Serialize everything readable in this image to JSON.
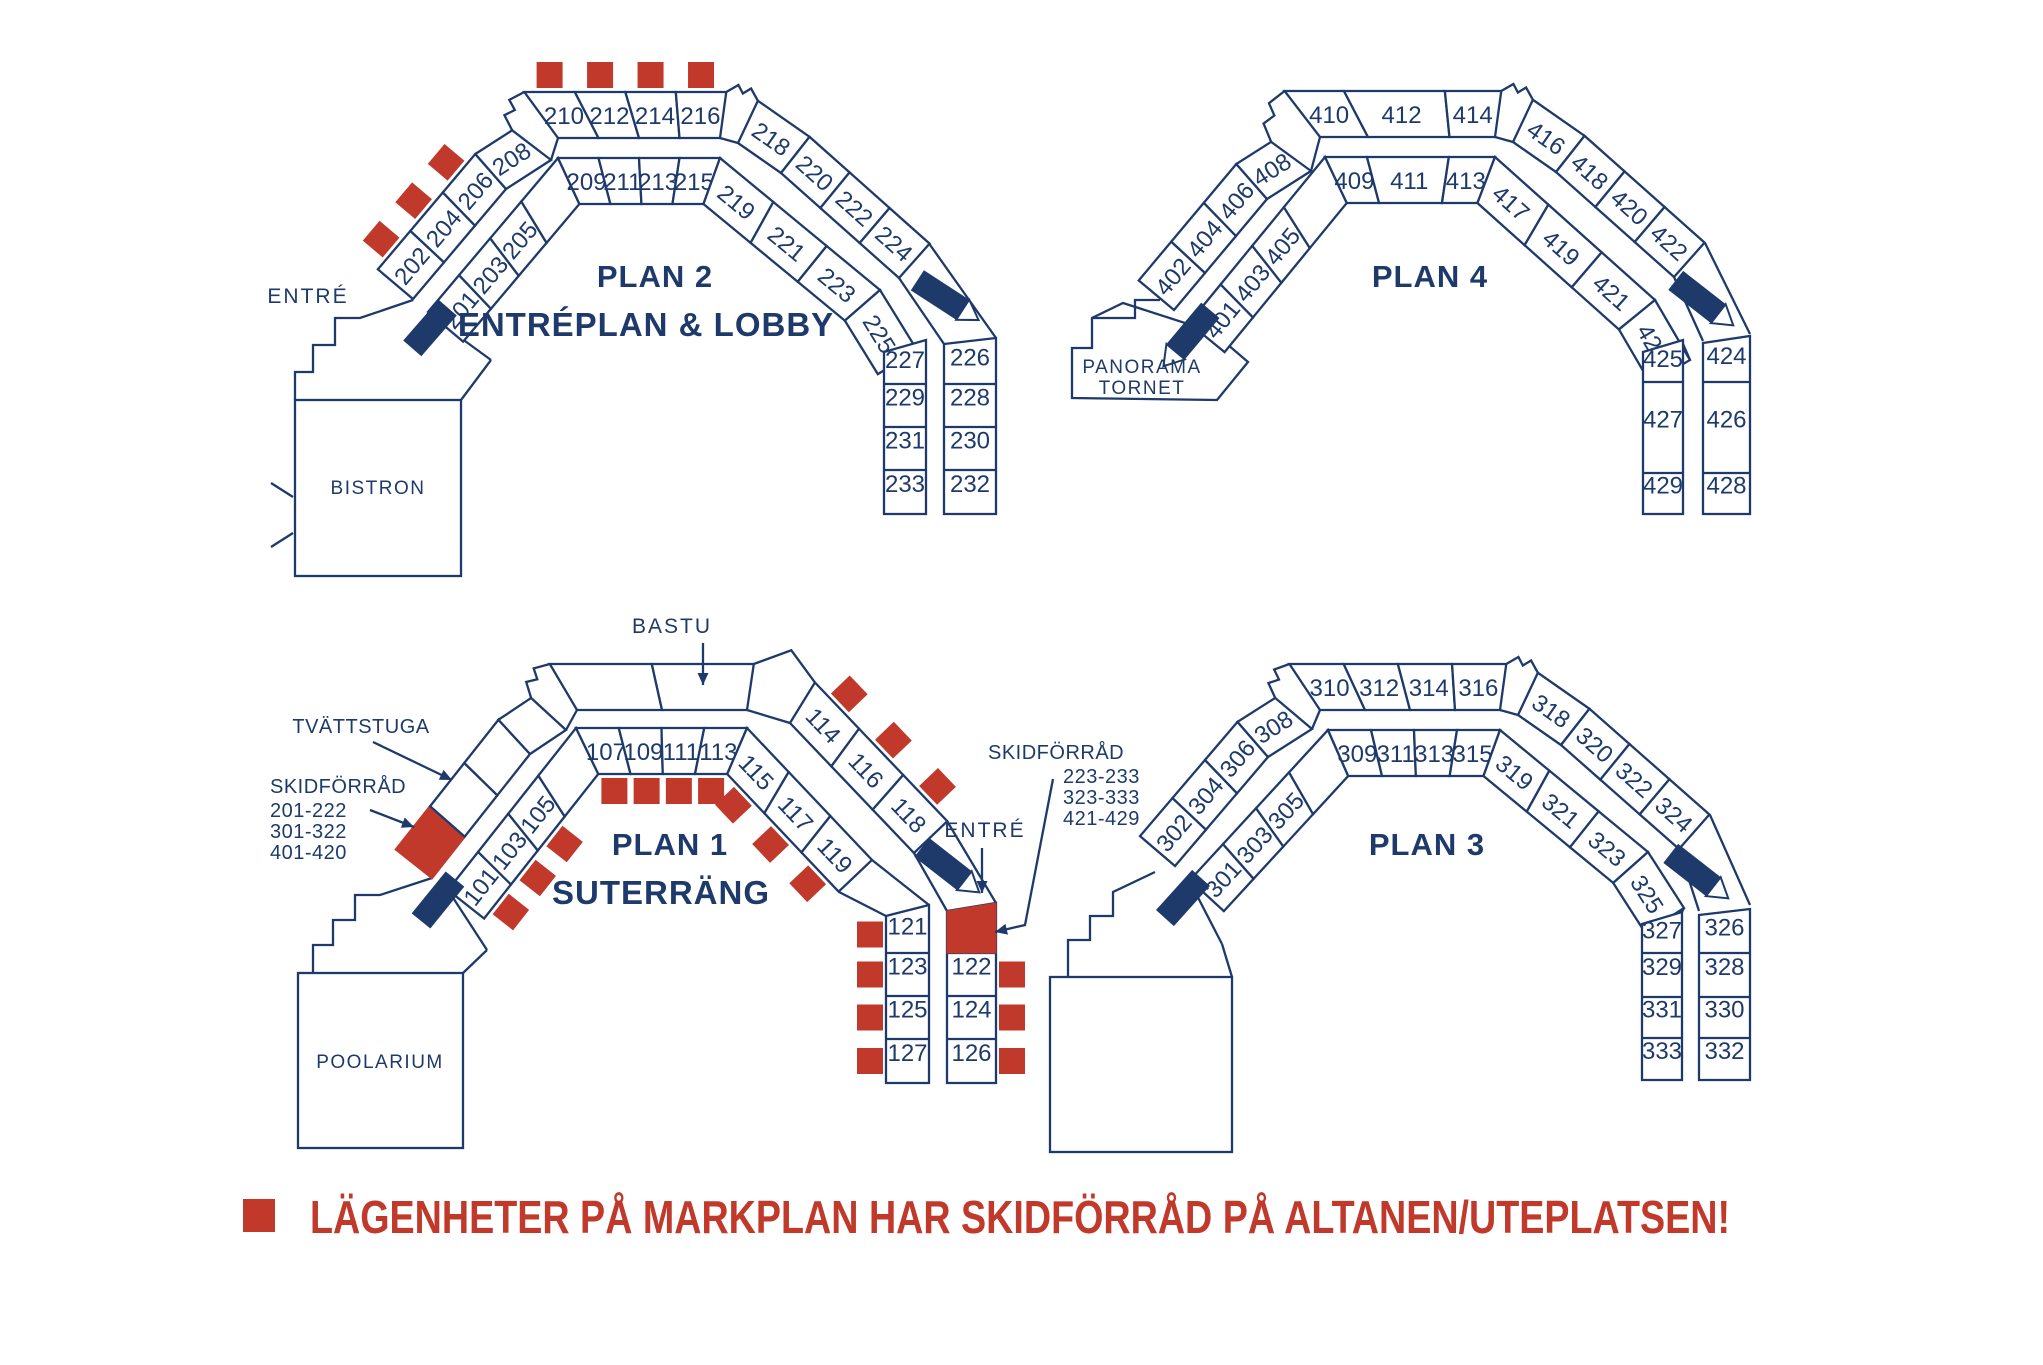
{
  "colors": {
    "navy": "#1e3a6b",
    "red": "#c0392b",
    "white": "#ffffff"
  },
  "labels": {
    "hiss": "Hiss",
    "entre": "ENTRÉ",
    "bastu": "BASTU",
    "tvattstuga": "TVÄTTSTUGA",
    "bistron": "BISTRON",
    "poolarium": "POOLARIUM",
    "panorama": [
      "PANORAMA",
      "TORNET"
    ],
    "skidforrad_title": "SKIDFÖRRÅD",
    "skidforrad_left_ranges": [
      "201-222",
      "301-322",
      "401-420"
    ],
    "skidforrad_right_ranges": [
      "223-233",
      "323-333",
      "421-429"
    ]
  },
  "legend": {
    "text": "LÄGENHETER PÅ MARKPLAN HAR SKIDFÖRRÅD PÅ ALTANEN/UTEPLATSEN!"
  },
  "plans": [
    {
      "id": "plan-2",
      "title": "PLAN 2",
      "subtitle": "ENTRÉPLAN & LOBBY",
      "inner_rooms": [
        "201",
        "203",
        "205",
        "209",
        "211",
        "213",
        "215",
        "219",
        "221",
        "223",
        "225"
      ],
      "outer_rooms": [
        "202",
        "204",
        "206",
        "208",
        "210",
        "212",
        "214",
        "216",
        "218",
        "220",
        "222",
        "224"
      ],
      "column_rooms_left": [
        "227",
        "229",
        "231",
        "233"
      ],
      "column_rooms_right": [
        "226",
        "228",
        "230",
        "232"
      ],
      "ski_storage_marked": [
        "202",
        "204",
        "206",
        "210",
        "212",
        "214",
        "216"
      ]
    },
    {
      "id": "plan-4",
      "title": "PLAN 4",
      "subtitle": "",
      "inner_rooms": [
        "401",
        "403",
        "405",
        "409",
        "411",
        "413",
        "417",
        "419",
        "421",
        "423"
      ],
      "outer_rooms": [
        "402",
        "404",
        "406",
        "408",
        "410",
        "412",
        "414",
        "416",
        "418",
        "420",
        "422"
      ],
      "column_rooms_left": [
        "425",
        "427",
        "429"
      ],
      "column_rooms_right": [
        "424",
        "426",
        "428"
      ],
      "ski_storage_marked": []
    },
    {
      "id": "plan-1",
      "title": "PLAN 1",
      "subtitle": "SUTERRÄNG",
      "inner_rooms": [
        "101",
        "103",
        "105",
        "107",
        "109",
        "111",
        "113",
        "115",
        "117",
        "119"
      ],
      "outer_rooms": [
        "114",
        "116",
        "118"
      ],
      "column_rooms_left": [
        "121",
        "123",
        "125",
        "127"
      ],
      "column_rooms_right": [
        "122",
        "124",
        "126"
      ],
      "ski_storage_marked": [
        "101",
        "103",
        "105",
        "107",
        "109",
        "111",
        "113",
        "115",
        "117",
        "119",
        "114",
        "116",
        "118",
        "121",
        "123",
        "125",
        "127",
        "122",
        "124",
        "126"
      ]
    },
    {
      "id": "plan-3",
      "title": "PLAN 3",
      "subtitle": "",
      "inner_rooms": [
        "301",
        "303",
        "305",
        "309",
        "311",
        "313",
        "315",
        "319",
        "321",
        "323",
        "325"
      ],
      "outer_rooms": [
        "302",
        "304",
        "306",
        "308",
        "310",
        "312",
        "314",
        "316",
        "318",
        "320",
        "322",
        "324"
      ],
      "column_rooms_left": [
        "327",
        "329",
        "331",
        "333"
      ],
      "column_rooms_right": [
        "326",
        "328",
        "330",
        "332"
      ],
      "ski_storage_marked": []
    }
  ]
}
